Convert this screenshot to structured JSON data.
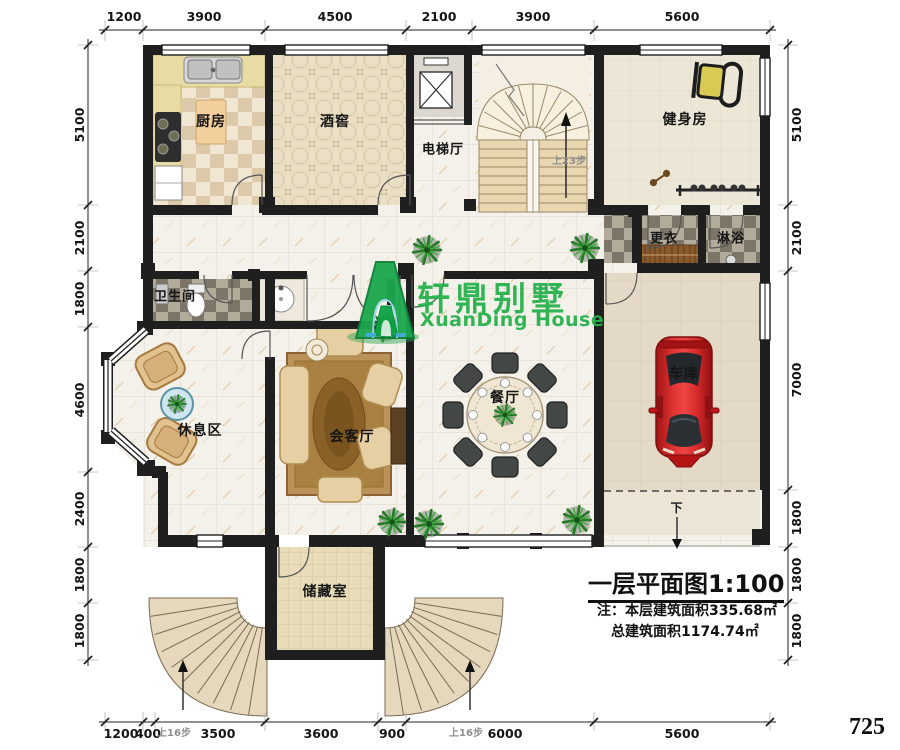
{
  "plan": {
    "rooms": {
      "kitchen": "厨房",
      "wine_cellar": "酒窖",
      "elevator_hall": "电梯厅",
      "gym": "健身房",
      "changing_room": "更衣",
      "shower": "淋浴",
      "bathroom": "卫生间",
      "lounge": "休息区",
      "reception": "会客厅",
      "dining": "餐厅",
      "garage": "车库",
      "storage": "储藏室"
    },
    "annotations": {
      "stairs_up_main": "上23步",
      "entry_steps_left": "上16步",
      "entry_steps_right": "上16步",
      "ramp_down": "下"
    }
  },
  "dimensions": {
    "top": [
      "1200",
      "3900",
      "4500",
      "2100",
      "3900",
      "5600"
    ],
    "bottom": [
      "1200",
      "400",
      "3500",
      "3600",
      "900",
      "6000",
      "5600"
    ],
    "left": [
      "5100",
      "2100",
      "1800",
      "4600",
      "2400",
      "1800",
      "1800"
    ],
    "right": [
      "5100",
      "2100",
      "7000",
      "1800",
      "1800",
      "1800"
    ]
  },
  "watermark": {
    "brand": "轩鼎别墅",
    "brand_en": "XuanDing House",
    "logo": "xuanding-logo",
    "color": "#26b14d"
  },
  "title_block": {
    "title": "一层平面图1:100",
    "note_line1": "注：本层建筑面积335.68㎡",
    "note_line2": "总建筑面积1174.74㎡"
  },
  "page_number": "725",
  "colors": {
    "wall": "#1f1f1f",
    "accent_green": "#26b14d",
    "car_red": "#c41f1f"
  }
}
